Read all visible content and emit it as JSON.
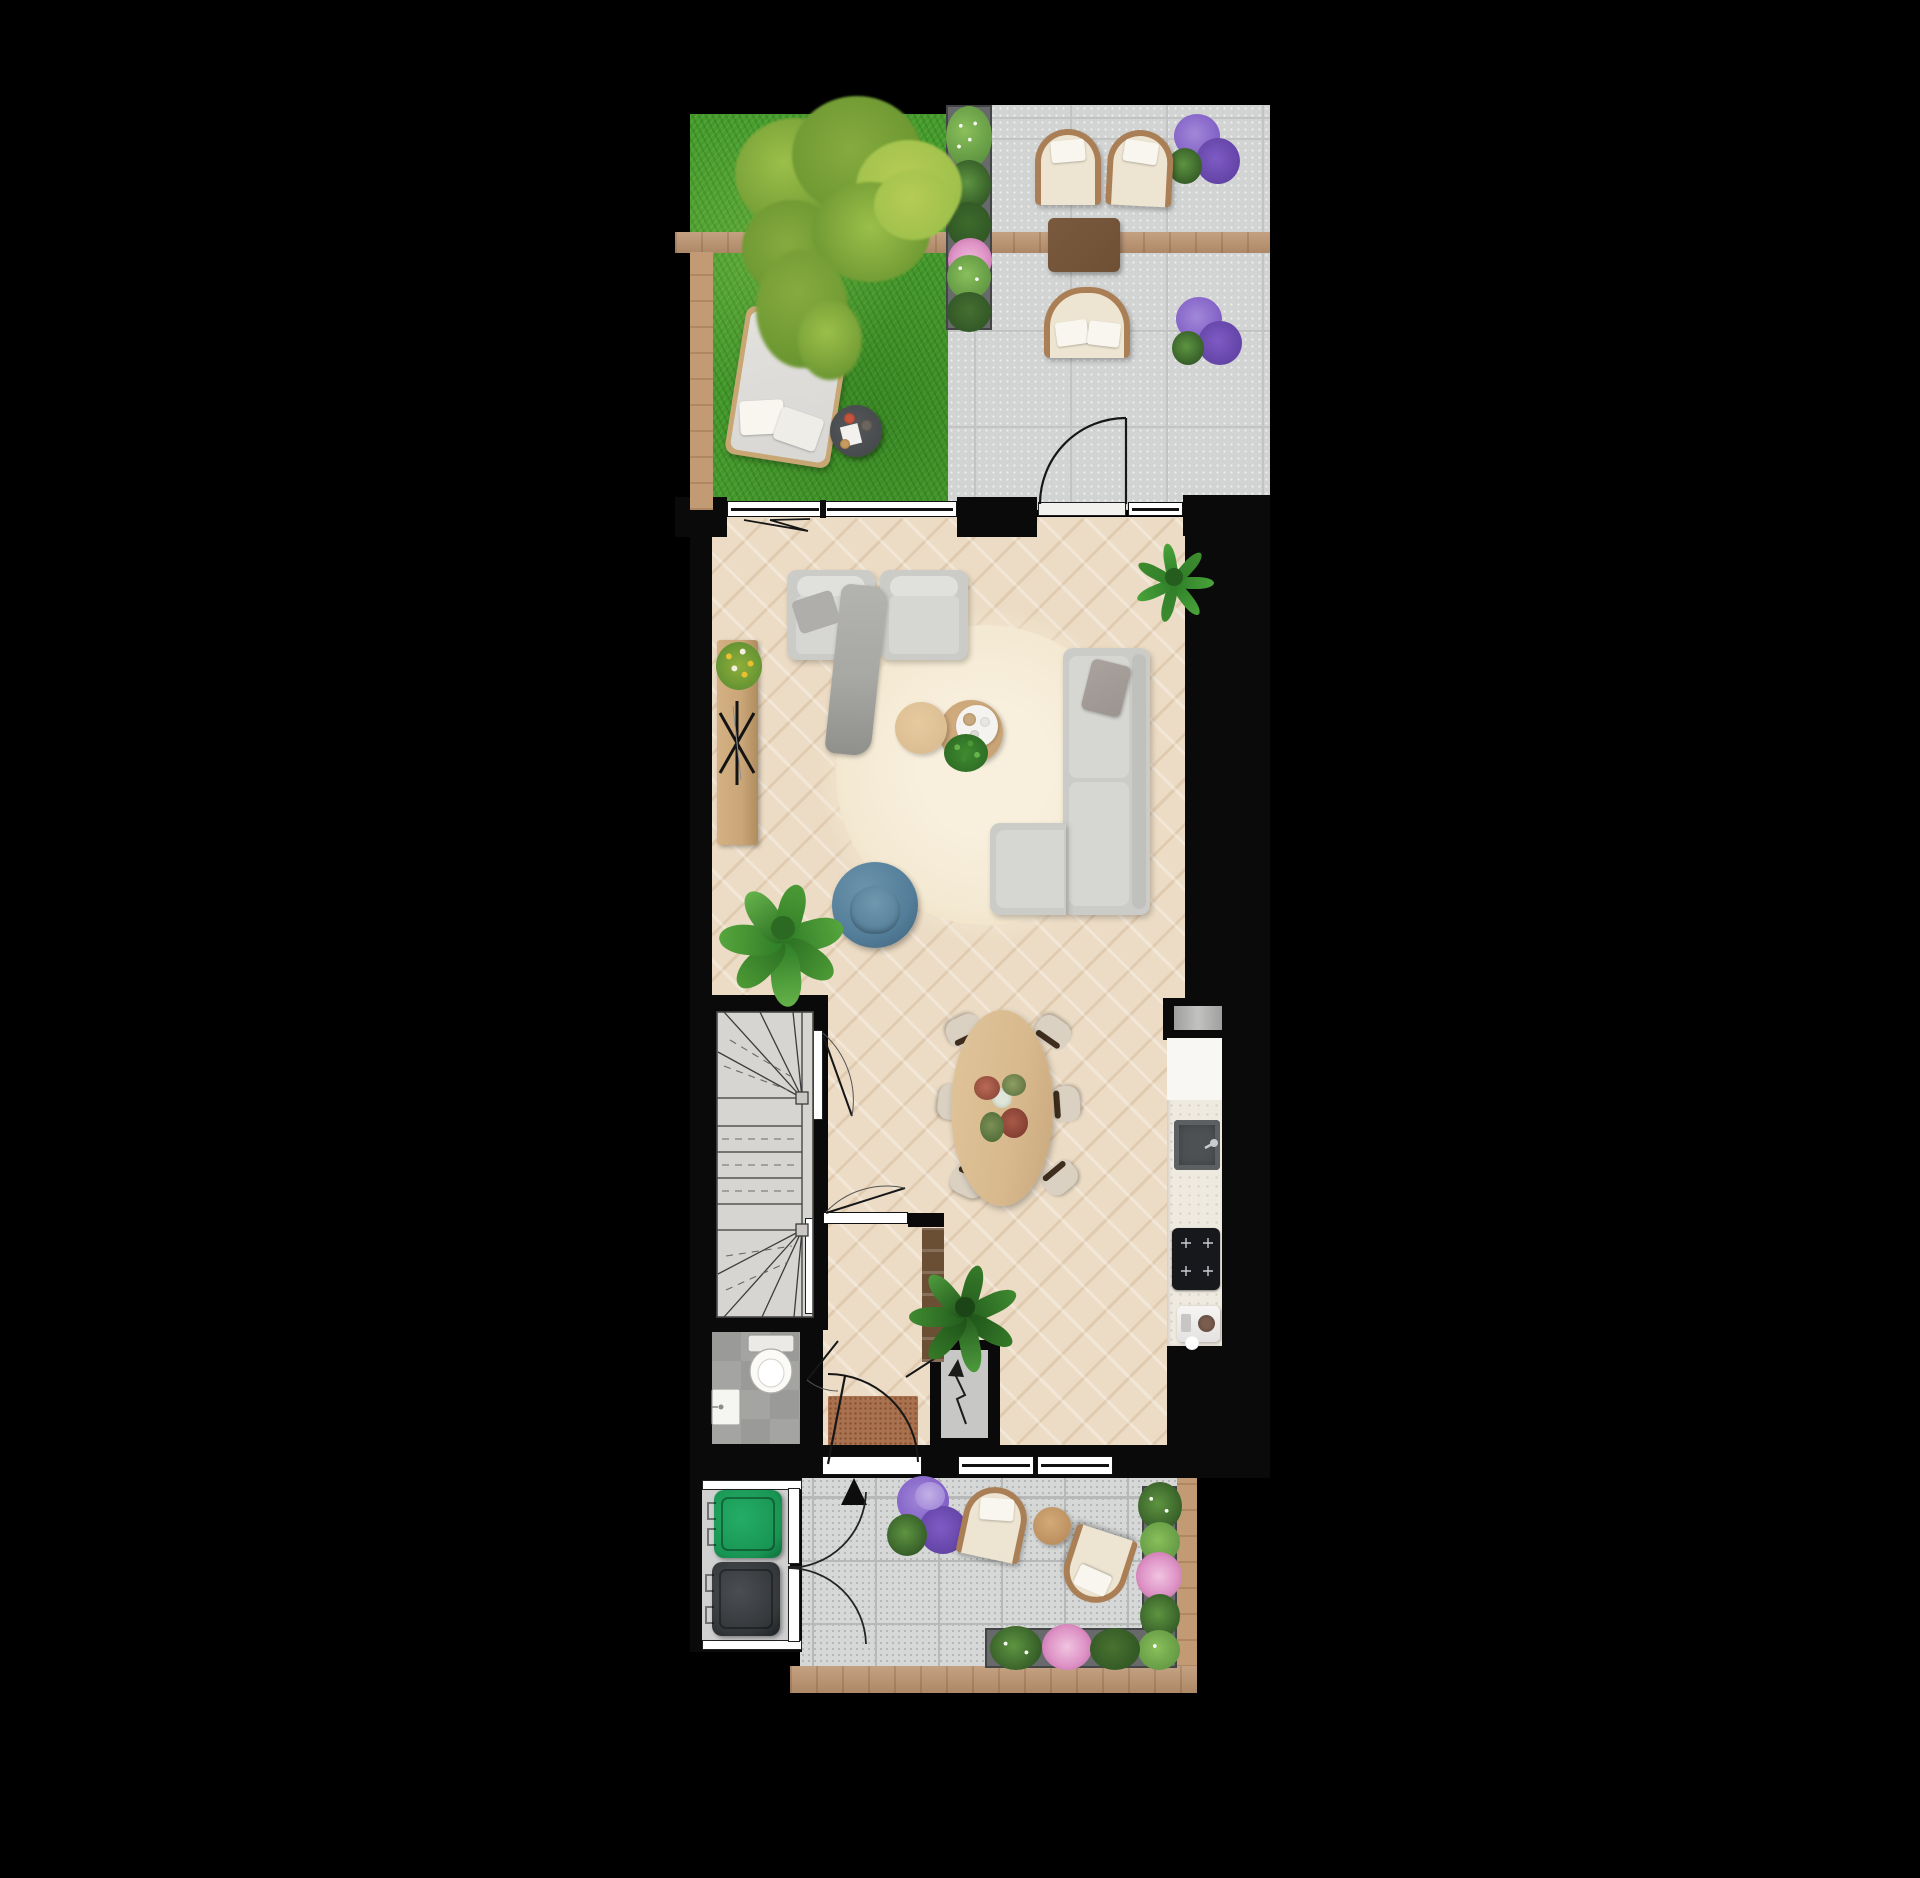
{
  "document": {
    "kind": "architectural floor plan rendering",
    "view": "top-down",
    "storey": "ground floor with garden and front yard",
    "visible_text": "none"
  },
  "colors": {
    "page_bg": "#000000",
    "grass": "#459c2c",
    "tree_mid": "#86ab3f",
    "tree_light": "#b5cc55",
    "tree_dark": "#67932f",
    "tree_olive": "#9cbf4a",
    "wood_beam": "#bc9470",
    "wood_fence": "#c29a74",
    "terrace_tile": "#d2d4d3",
    "terrace_grout": "#c2c4c3",
    "planter_box": "#67696a",
    "bush_green": "#5d9440",
    "bush_dark": "#2f5424",
    "bush_light": "#8abf5b",
    "flower_white": "#f4f6f0",
    "flower_pink": "#de93c6",
    "flower_purple": "#7e5bc4",
    "flower_purple_light": "#a188d8",
    "chair_frame": "#aa7f55",
    "chair_cushion": "#ede5d1",
    "pillow_white": "#f9f6ef",
    "outdoor_table_brown": "#6e5035",
    "daybed_mattress": "#d8d7d4",
    "side_table_dark": "#46494b",
    "parquet": "#ecdcc5",
    "parquet_seam": "#d8c1a5",
    "wall_black": "#0a0a0a",
    "frame_white": "#ffffff",
    "rug_cream": "#f4e9d2",
    "sofa_grey": "#cbcbc7",
    "sofa_cushion": "#d6d6d2",
    "pillow_grey": "#9c9490",
    "throw_grey": "#a7a7a3",
    "coffee_table_wood": "#c8a273",
    "coffee_table_light": "#dcbd92",
    "tray_white": "#f4f3f0",
    "chair_blue": "#537d99",
    "plant_green": "#3f8a2f",
    "plant_dark": "#2c6a24",
    "sideboard_wood": "#c9a577",
    "tulip_yellow": "#e9c130",
    "dining_table_wood": "#d8b98d",
    "dining_chair_seat": "#dad1c2",
    "dining_chair_back": "#3f2e1d",
    "counter": "#efeae0",
    "counter_white": "#f8f7f3",
    "sink_dark": "#4e5153",
    "cooktop_black": "#16181c",
    "stair_floor": "#d7d5d1",
    "wc_tile": "#a4a4a2",
    "wc_tile_alt": "#9a9a98",
    "mat_brown": "#a9714e",
    "yard_tile": "#d6d8d7",
    "yard_grout": "#b7b9b8",
    "bin_green": "#199553",
    "bin_grey": "#34373a",
    "enclosure_floor": "#cfd0cf",
    "meter_floor": "#c7c7c5",
    "cabinet_brown": "#6b4f35"
  },
  "areas": {
    "garden": {
      "objects": [
        "lawn",
        "tree",
        "pergola-beam",
        "fence-post",
        "daybed-lounger",
        "tray-side-table"
      ]
    },
    "terrace": {
      "objects": [
        "lounge-chair",
        "lounge-chair",
        "outdoor-table",
        "loveseat-bench",
        "planter-hedge",
        "purple-flowers",
        "purple-flowers",
        "terrace-door"
      ]
    },
    "living_room": {
      "objects": [
        "armchair",
        "armchair",
        "throw-blanket",
        "round-rug",
        "coffee-table",
        "coffee-table-small",
        "serving-tray",
        "table-plant",
        "corner-sofa",
        "grey-cushion",
        "sideboard",
        "tulip-bouquet",
        "star-decor",
        "blue-tub-chair",
        "fiddle-leaf-plant",
        "palm-plant",
        "folding-door",
        "window"
      ]
    },
    "dining": {
      "objects": [
        "oval-table",
        "dining-chair",
        "dining-chair",
        "dining-chair",
        "dining-chair",
        "dining-chair",
        "dining-chair",
        "flower-centerpiece"
      ]
    },
    "kitchen": {
      "objects": [
        "wall-niche",
        "counter",
        "sink",
        "faucet",
        "induction-cooktop",
        "espresso-machine",
        "tall-cabinet",
        "house-plant"
      ]
    },
    "stairwell": {
      "objects": [
        "winder-staircase",
        "stair-door",
        "understairs-door"
      ]
    },
    "hallway": {
      "objects": [
        "hall-door",
        "doormat",
        "front-door",
        "entrance-arrow",
        "meter-cupboard",
        "electric-symbol",
        "doorbell-box",
        "window",
        "window"
      ]
    },
    "toilet": {
      "objects": [
        "toilet",
        "hand-basin",
        "wc-door"
      ]
    },
    "front_yard": {
      "objects": [
        "paving",
        "purple-bush",
        "lounge-chair",
        "lounge-chair",
        "side-table",
        "planter-border-right",
        "planter-border-bottom",
        "wood-fence",
        "bin-store",
        "green-bin",
        "grey-bin",
        "gate",
        "gate"
      ]
    }
  }
}
